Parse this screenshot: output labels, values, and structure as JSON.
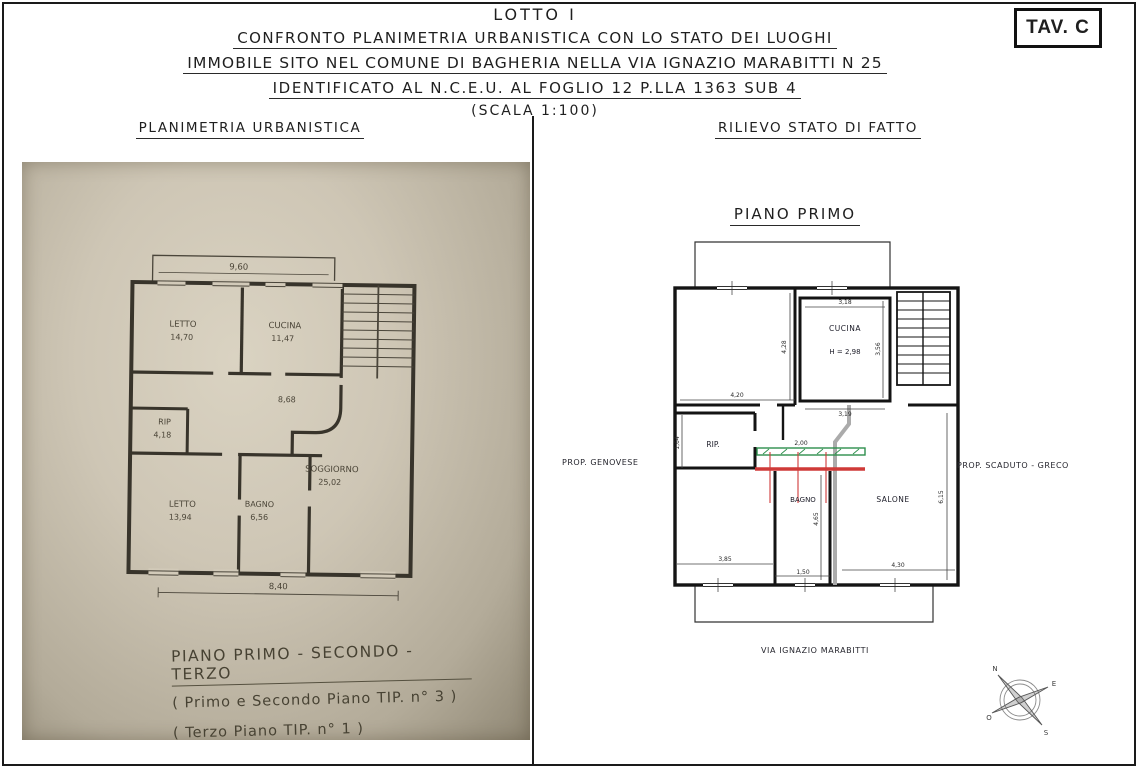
{
  "header": {
    "lotto": "LOTTO I",
    "line1": "CONFRONTO PLANIMETRIA URBANISTICA CON LO STATO DEI LUOGHI",
    "line2": "IMMOBILE SITO NEL COMUNE DI BAGHERIA NELLA VIA IGNAZIO MARABITTI N 25",
    "line3": "IDENTIFICATO AL N.C.E.U. AL FOGLIO 12 P.LLA 1363 SUB 4",
    "scale": "(SCALA 1:100)",
    "sheet": "TAV. C"
  },
  "left": {
    "title": "PLANIMETRIA URBANISTICA",
    "plan": {
      "balcony_dim": "9,60",
      "corridor_dim": "8,68",
      "bottom_dim": "8,40",
      "rooms": {
        "letto1": {
          "label": "LETTO",
          "area": "14,70"
        },
        "cucina": {
          "label": "CUCINA",
          "area": "11,47"
        },
        "rip": {
          "label": "RIP",
          "area": "4,18"
        },
        "letto2": {
          "label": "LETTO",
          "area": "13,94"
        },
        "bagno": {
          "label": "BAGNO",
          "area": "6,56"
        },
        "soggiorno": {
          "label": "SOGGIORNO",
          "area": "25,02"
        }
      }
    },
    "caption": {
      "title": "PIANO PRIMO - SECONDO - TERZO",
      "sub1": "( Primo e Secondo Piano TIP. n° 3 )",
      "sub2": "( Terzo Piano TIP. n° 1 )"
    }
  },
  "right": {
    "title": "RILIEVO STATO DI FATTO",
    "plan_title": "PIANO PRIMO",
    "rooms": {
      "cucina": {
        "label": "CUCINA",
        "height": "H = 2,98"
      },
      "rip": {
        "label": "RIP."
      },
      "bagno": {
        "label": "BAGNO"
      },
      "salone": {
        "label": "SALONE"
      }
    },
    "dims": {
      "room_tl_w": "4,20",
      "room_tl_h": "4,28",
      "cucina_w_top": "3,18",
      "cucina_w_bot": "3,19",
      "cucina_h_right": "3,56",
      "rip_h": "1,64",
      "passage_w": "2,00",
      "bagno_h": "4,65",
      "bagno_w": "1,50",
      "salone_w": "4,30",
      "salone_h": "6,15",
      "room_bl_w": "3,85"
    },
    "neighbors": {
      "left": "PROP. GENOVESE",
      "right": "PROP. SCADUTO - GRECO"
    },
    "street": "VIA IGNAZIO MARABITTI",
    "compass": {
      "n": "N",
      "e": "E",
      "s": "S",
      "o": "O"
    }
  },
  "colors": {
    "wall": "#141414",
    "demolition_green": "#2e8f4d",
    "new_wall_red": "#cf3a38",
    "existing_gray": "#ababab",
    "photo_paper": "#cec6b5",
    "photo_ink": "#3a362e"
  }
}
